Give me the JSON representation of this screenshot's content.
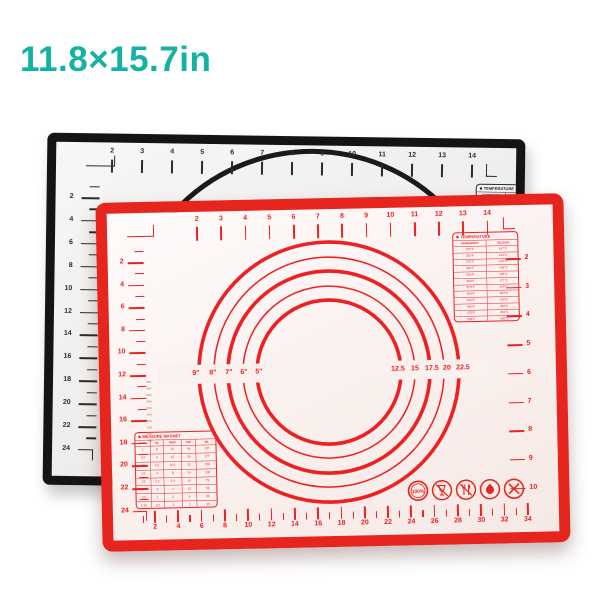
{
  "title": "11.8×15.7in",
  "colors": {
    "teal": "#14b2a2",
    "red_border": "#e6251f",
    "red_ink": "#ed2024",
    "black_border": "#141414",
    "black_ink": "#2b2b2b"
  },
  "black_mat": {
    "top_ruler": {
      "left_label": "inches",
      "numbers": [
        "2",
        "3",
        "4",
        "5",
        "6",
        "7",
        "8",
        "9",
        "10",
        "11",
        "12",
        "13",
        "14"
      ],
      "right_label": "inches"
    },
    "left_ruler": {
      "top_label": "cm",
      "numbers": [
        "2",
        "4",
        "6",
        "8",
        "10",
        "12",
        "14",
        "16",
        "18",
        "20",
        "22",
        "24"
      ],
      "bottom_label": "cm"
    },
    "temperature_box": {
      "title": "TEMPERATURE",
      "columns": [
        "FAHRENHEIT",
        "CELSIUS"
      ],
      "rows": [
        [
          "225°F",
          "107°C"
        ],
        [
          "250°F",
          "121°C"
        ],
        [
          "275°F",
          "135°C"
        ],
        [
          "300°F",
          "149°C"
        ],
        [
          "325°F",
          "163°C"
        ],
        [
          "350°F",
          "177°C"
        ],
        [
          "375°F",
          "190°C"
        ],
        [
          "400°F",
          "204°C"
        ],
        [
          "425°F",
          "218°C"
        ],
        [
          "450°F",
          "232°C"
        ],
        [
          "475°F",
          "246°C"
        ],
        [
          "500°F",
          "260°C"
        ]
      ]
    }
  },
  "red_mat": {
    "top_ruler": {
      "left_label": "inches",
      "unit_left": "cm",
      "numbers": [
        "2",
        "3",
        "4",
        "5",
        "6",
        "7",
        "8",
        "9",
        "10",
        "11",
        "12",
        "13",
        "14"
      ],
      "right_label": "inches"
    },
    "left_ruler": {
      "numbers": [
        "2",
        "4",
        "6",
        "8",
        "10",
        "12",
        "14",
        "16",
        "18",
        "20",
        "22",
        "24"
      ]
    },
    "right_ruler": {
      "numbers": [
        "2",
        "3",
        "4",
        "5",
        "6",
        "7",
        "8",
        "9",
        "10"
      ]
    },
    "bottom_ruler": {
      "unit_label": "cm",
      "numbers": [
        "2",
        "4",
        "6",
        "8",
        "10",
        "12",
        "14",
        "16",
        "18",
        "20",
        "22",
        "24",
        "26",
        "28",
        "30",
        "32",
        "34"
      ]
    },
    "circles": {
      "left_unit": "inches",
      "inch_labels": [
        "9\"",
        "8\"",
        "7\"",
        "6\"",
        "5\""
      ],
      "cm_labels": [
        "12.5",
        "15",
        "17.5",
        "20",
        "22.5"
      ],
      "right_unit": "cm"
    },
    "temperature_box": {
      "title": "TEMPERATURE",
      "columns": [
        "FAHRENHEIT",
        "CELSIUS"
      ],
      "rows": [
        [
          "225°F",
          "107°C"
        ],
        [
          "250°F",
          "121°C"
        ],
        [
          "275°F",
          "135°C"
        ],
        [
          "300°F",
          "149°C"
        ],
        [
          "325°F",
          "163°C"
        ],
        [
          "350°F",
          "177°C"
        ],
        [
          "375°F",
          "190°C"
        ],
        [
          "400°F",
          "204°C"
        ],
        [
          "425°F",
          "218°C"
        ],
        [
          "450°F",
          "232°C"
        ],
        [
          "475°F",
          "246°C"
        ],
        [
          "500°F",
          "260°C"
        ]
      ]
    },
    "measure_box": {
      "title": "MEASURE MAGNET",
      "columns": [
        "CUP",
        "OZ",
        "TBSP",
        "TSP",
        "ML"
      ],
      "rows": [
        [
          "1",
          "8",
          "16",
          "48",
          "237"
        ],
        [
          "3/4",
          "6",
          "12",
          "36",
          "177"
        ],
        [
          "2/3",
          "5.3",
          "10.6",
          "32",
          "158"
        ],
        [
          "1/2",
          "4",
          "8",
          "24",
          "118"
        ],
        [
          "1/3",
          "2.6",
          "5.3",
          "16",
          "79"
        ],
        [
          "1/4",
          "2",
          "4",
          "12",
          "59"
        ],
        [
          "1/8",
          "1",
          "2",
          "6",
          "30"
        ],
        [
          "1/16",
          "1/2",
          "1",
          "3",
          "15"
        ]
      ]
    },
    "safety": {
      "percent_label": "100%"
    }
  }
}
